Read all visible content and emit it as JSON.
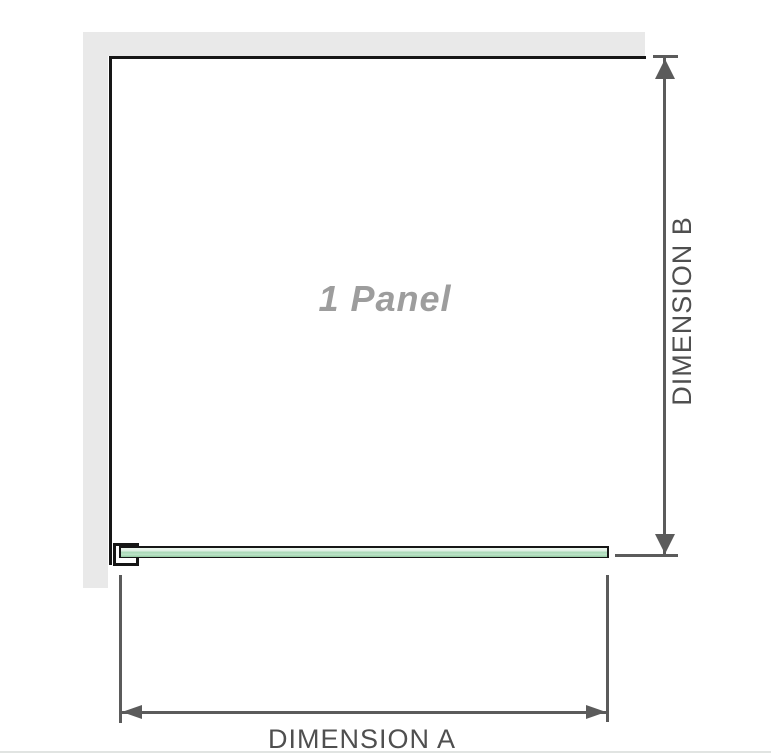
{
  "diagram": {
    "panel_caption": "1 Panel",
    "dimension_a_label": "DIMENSION A",
    "dimension_b_label": "DIMENSION B"
  },
  "colors": {
    "wall": "#e9e9e9",
    "outline": "#161616",
    "dimension_line": "#5b5b5b",
    "label_text": "#4f4f4f",
    "panel_label_text": "#9d9d9d",
    "glass_light": "#eef7f0",
    "glass_green": "#a7d8b5",
    "glass_dark_green": "#8fcaa0",
    "divider": "#e1e4e2"
  }
}
